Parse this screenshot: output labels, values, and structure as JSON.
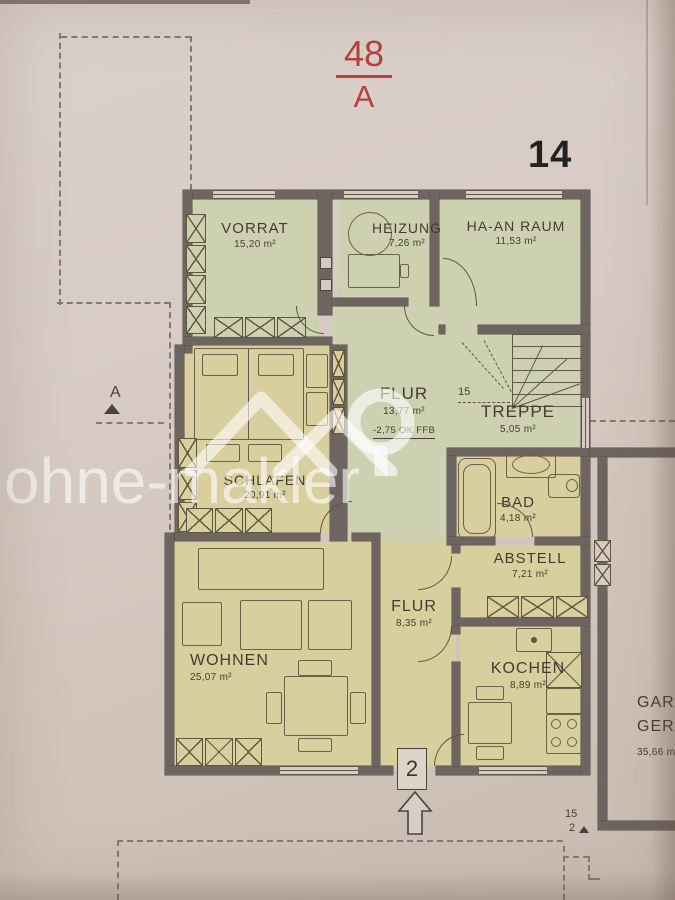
{
  "meta": {
    "plan_code_top": "48",
    "plan_code_bottom": "A",
    "sheet_number": "14"
  },
  "watermark": {
    "text": "ohne-makler"
  },
  "rooms": {
    "vorrat": {
      "name": "VORRAT",
      "area": "15,20 m²"
    },
    "heizung": {
      "name": "HEIZUNG",
      "area": "7,26 m²"
    },
    "ha_an_raum": {
      "name": "HA-AN RAUM",
      "area": "11,53 m²"
    },
    "flur_mitte": {
      "name": "FLUR",
      "area": "13,77 m²",
      "note": "-2,75 OK FFB"
    },
    "treppe": {
      "name": "TREPPE",
      "area": "5,05 m²",
      "step_count": "15"
    },
    "schlafen": {
      "name": "SCHLAFEN",
      "area": "20,91 m²"
    },
    "bad": {
      "name": "BAD",
      "area": "4,18 m²"
    },
    "abstell": {
      "name": "ABSTELL",
      "area": "7,21 m²"
    },
    "flur_unten": {
      "name": "FLUR",
      "area": "8,35 m²"
    },
    "wohnen": {
      "name": "WOHNEN",
      "area": "25,07 m²"
    },
    "kochen": {
      "name": "KOCHEN",
      "area": "8,89 m²"
    },
    "garage": {
      "name_line1": "GAR",
      "name_line2": "GER",
      "area": "35,66 m"
    }
  },
  "markers": {
    "section_label": "A",
    "entrance_number": "2",
    "boundary_count_top": "15",
    "boundary_count_bottom": "2"
  },
  "colors": {
    "accent_red": "#b4423c",
    "paper": "#d6cac2",
    "room_green": "#cdd1b2",
    "room_tan": "#d8ce9e",
    "wall": "#6e6460",
    "ink": "#443d2f",
    "dash": "#857a6e",
    "line": "#5f564a",
    "watermark": "rgba(255,255,255,0.6)"
  }
}
